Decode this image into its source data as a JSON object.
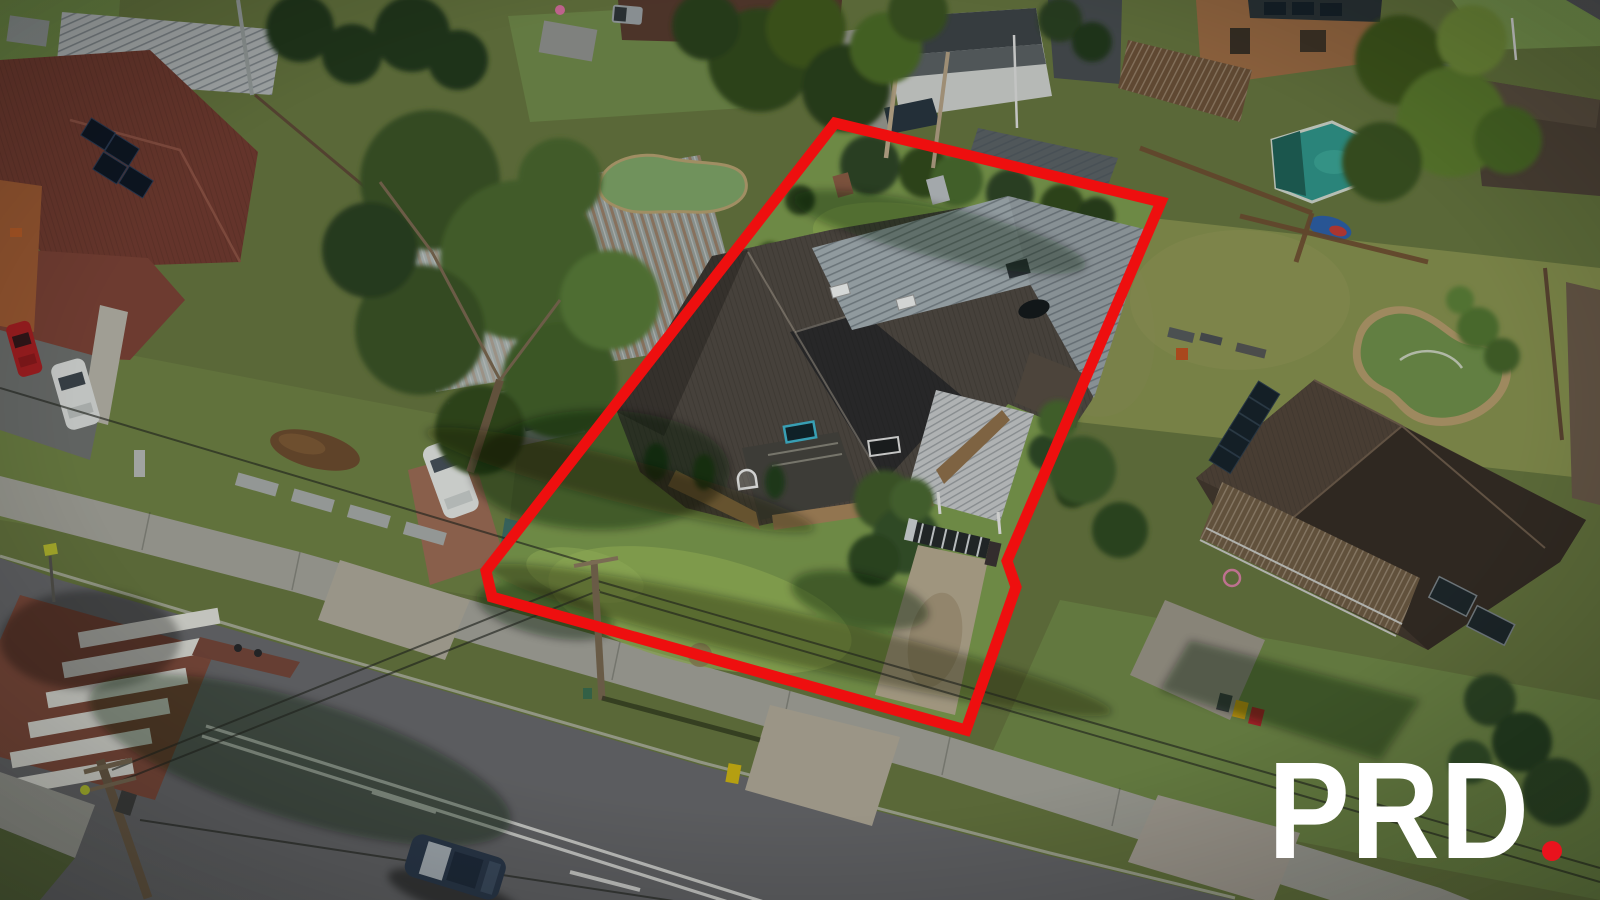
{
  "watermark": {
    "text": "PRD",
    "text_color": "#ffffff",
    "dot_color": "#e9131d"
  },
  "boundary": {
    "color": "#ee0f0f"
  },
  "palette": {
    "pool_teal": "#2f958a",
    "pond_green": "#6f8f4a",
    "lawn_green": "#7c9a4e",
    "road_grey": "#69696d",
    "roof_dark": "#4f4842",
    "metal_roof": "#a3adb3"
  }
}
